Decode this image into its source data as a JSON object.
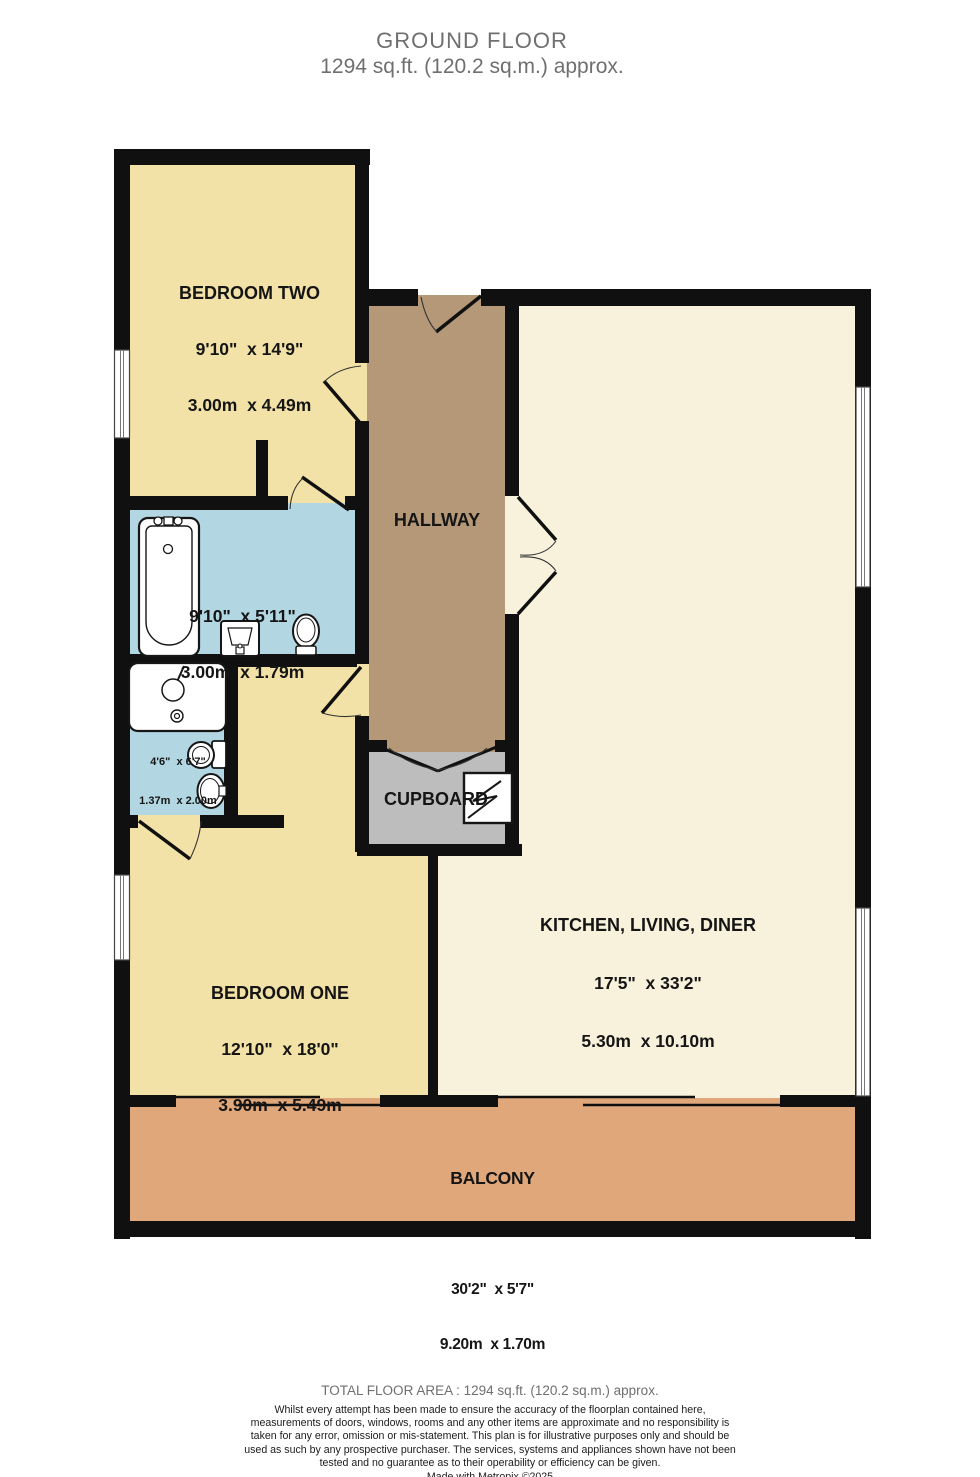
{
  "header": {
    "title": "GROUND FLOOR",
    "subtitle": "1294 sq.ft. (120.2 sq.m.) approx."
  },
  "rooms": {
    "bedroom_two": {
      "name": "BEDROOM TWO",
      "dims_imperial": "9'10\"  x 14'9\"",
      "dims_metric": "3.00m  x 4.49m"
    },
    "bathroom": {
      "dims_imperial": "9'10\"  x 5'11\"",
      "dims_metric": "3.00m  x 1.79m"
    },
    "wc": {
      "dims_imperial": "4'6\"  x 6'7\"",
      "dims_metric": "1.37m  x 2.00m"
    },
    "hallway": {
      "name": "HALLWAY"
    },
    "cupboard": {
      "name": "CUPBOARD"
    },
    "kitchen": {
      "name": "KITCHEN, LIVING, DINER",
      "dims_imperial": "17'5\"  x 33'2\"",
      "dims_metric": "5.30m  x 10.10m"
    },
    "bedroom_one": {
      "name": "BEDROOM ONE",
      "dims_imperial": "12'10\"  x 18'0\"",
      "dims_metric": "3.90m  x 5.49m"
    },
    "balcony": {
      "name": "BALCONY",
      "dims_imperial": "30'2\"  x 5'7\"",
      "dims_metric": "9.20m  x 1.70m"
    }
  },
  "footer": {
    "total": "TOTAL FLOOR AREA : 1294 sq.ft. (120.2 sq.m.) approx.",
    "disclaimer": "Whilst every attempt has been made to ensure the accuracy of the floorplan contained here, measurements of doors, windows, rooms and any other items are approximate and no responsibility is taken for any error, omission or mis-statement. This plan is for illustrative purposes only and should be used as such by any prospective purchaser. The services, systems and appliances shown have not been tested and no guarantee as to their operability or efficiency can be given.",
    "credit": "Made with Metropix ©2025"
  },
  "colors": {
    "bedroom_yellow": "#f3e2a7",
    "kitchen_cream": "#f8f2dc",
    "hallway_tan": "#b49877",
    "bathroom_blue": "#b2d7e2",
    "cupboard_gray": "#bdbdbd",
    "balcony_orange": "#e0a77b",
    "wall_black": "#101010"
  }
}
